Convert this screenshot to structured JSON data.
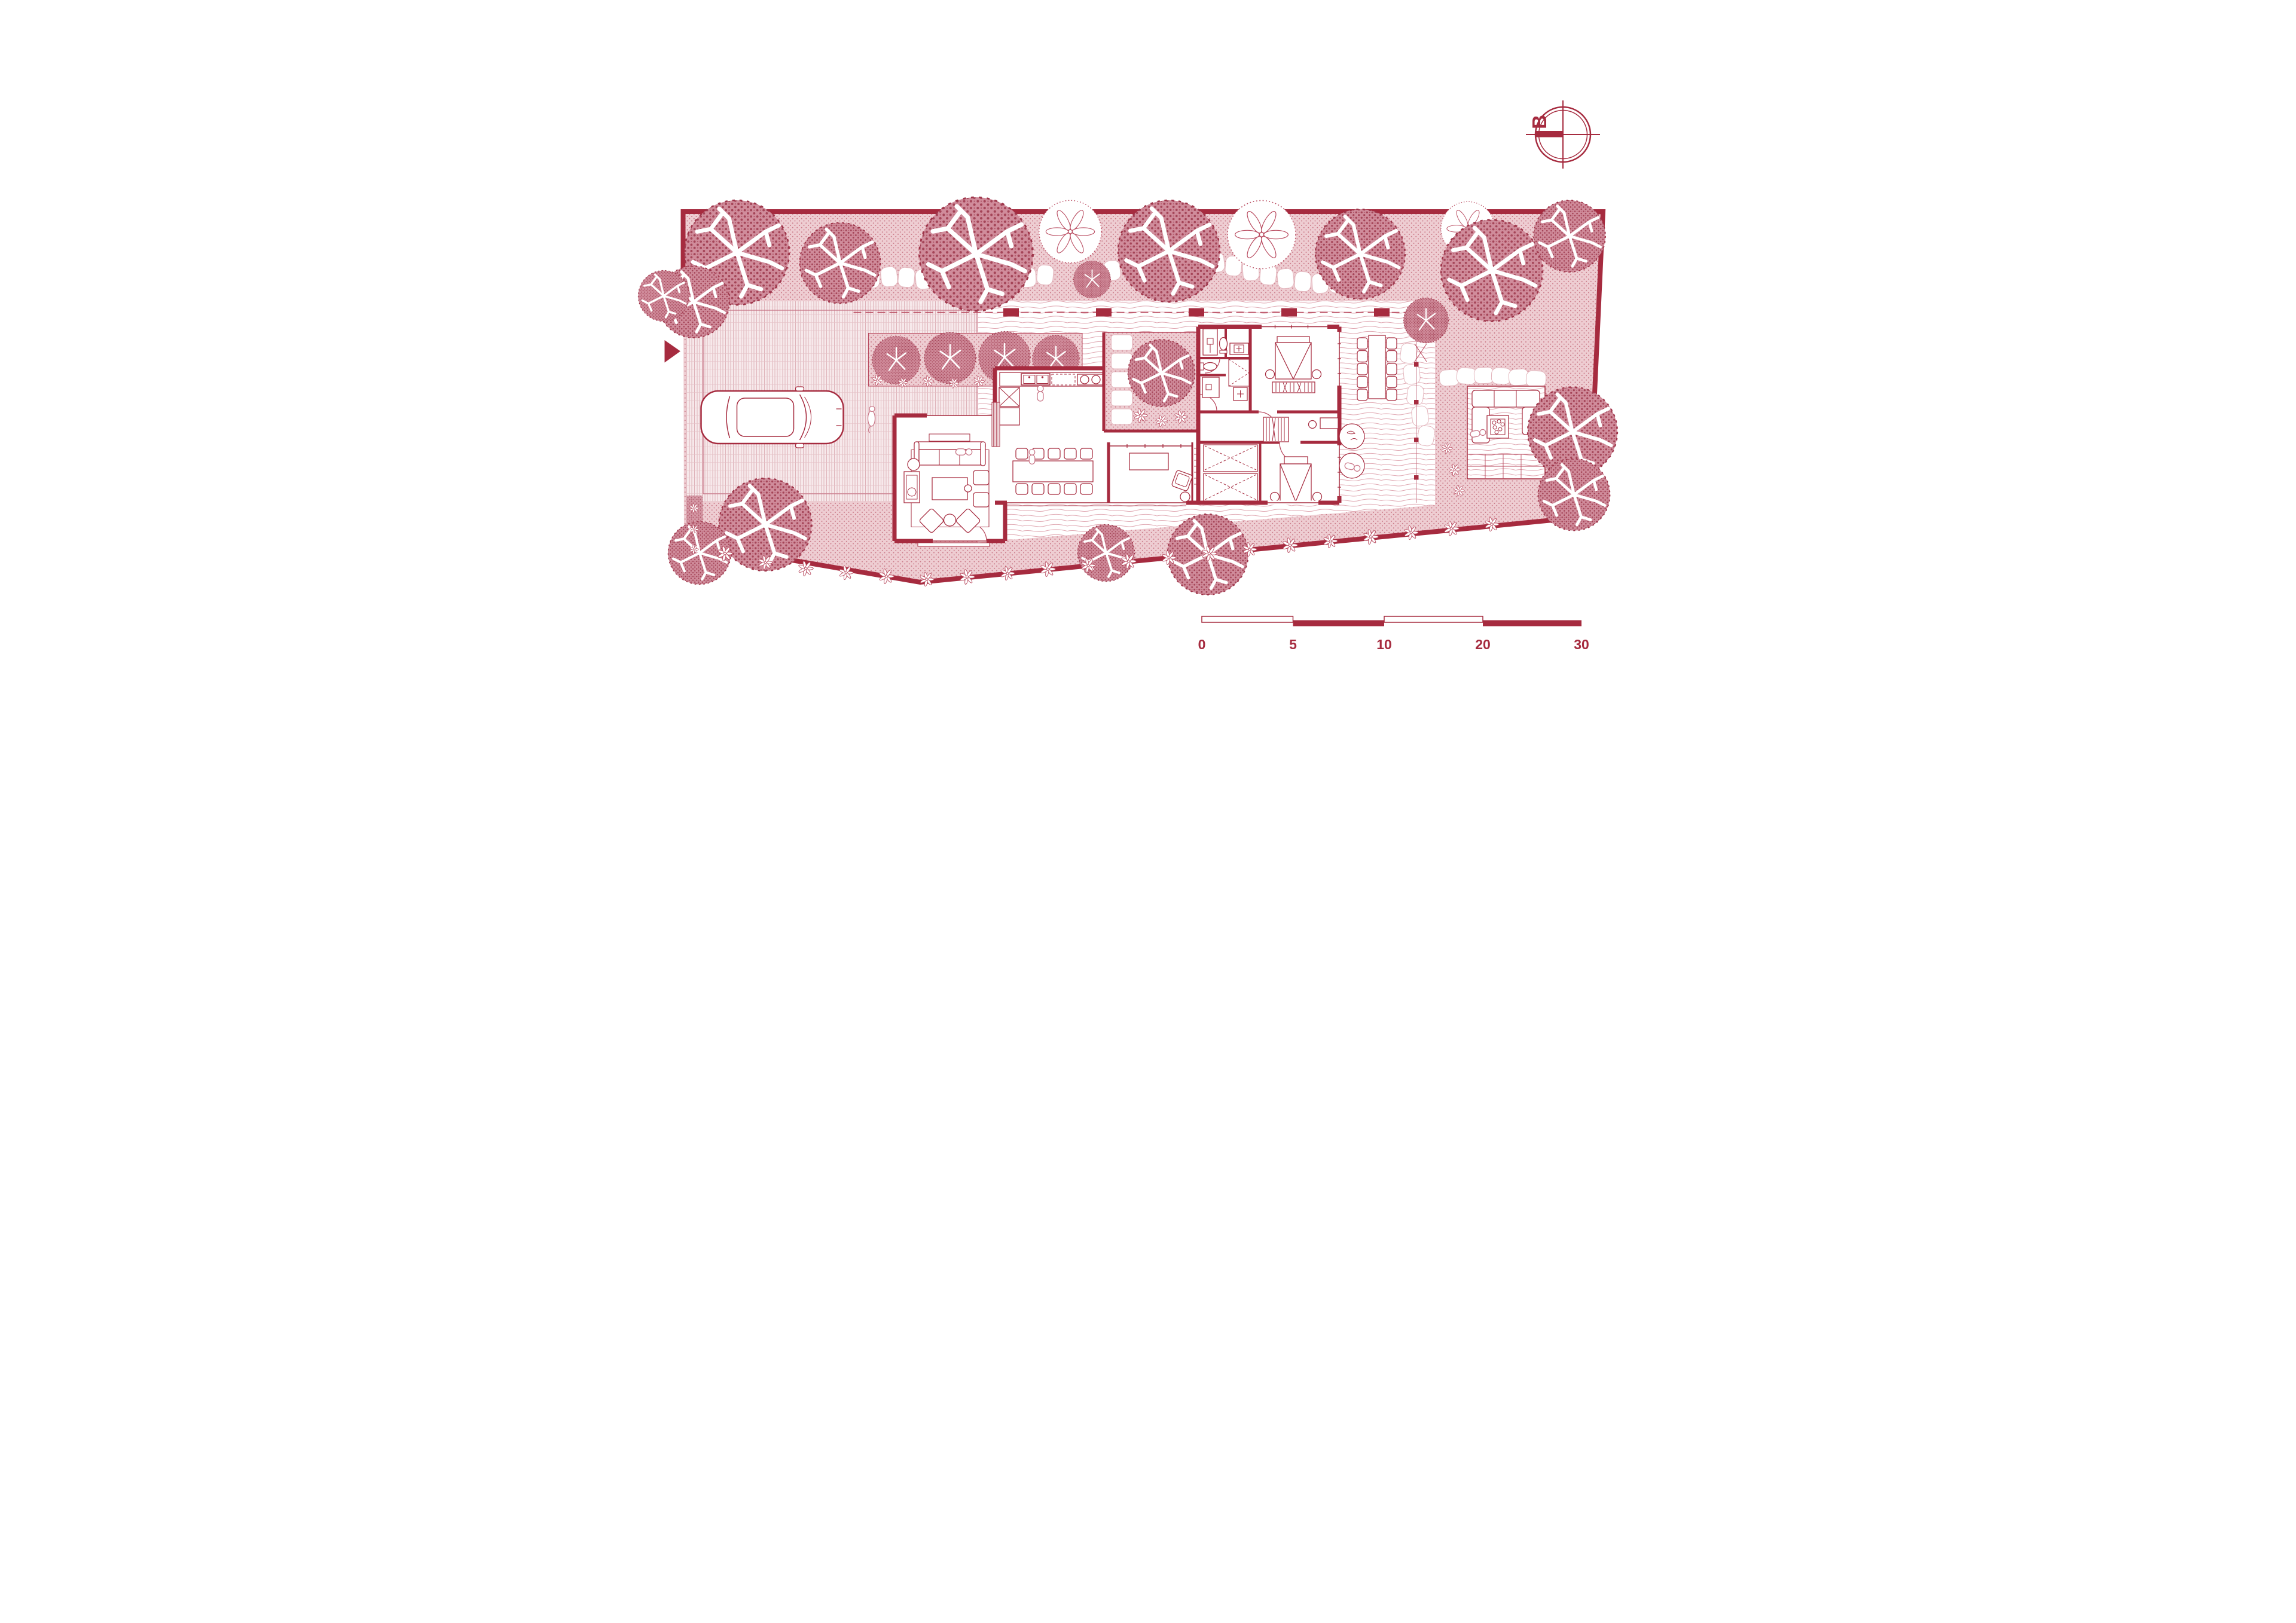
{
  "drawing": {
    "type": "architectural ground-floor site plan",
    "technique": "monochrome crimson ink drawing on white paper",
    "compass": {
      "letter": "B"
    },
    "scale_bar": {
      "labels": [
        "0",
        "5",
        "10",
        "20",
        "30"
      ],
      "style": "staggered alternating open and filled bar segments"
    },
    "palette": {
      "primary_red": "#a62b3f",
      "soft_pink": "#eecdd2",
      "dot_pink": "#b24458",
      "canopy_pink": "#d08c9b",
      "canopy_dot": "#993246",
      "lawn_line": "#e0a8b2",
      "hatch_line": "#d8a4ad",
      "stone_outline": "#e3b6bd",
      "paper": "#ffffff"
    },
    "site": {
      "shape": "irregular walled quadrilateral with slanted bottom boundary",
      "entry": "arrow marker at left boundary into driveway court",
      "zones": [
        "perimeter stippled garden with large canopy trees",
        "winding stepping-stone path along the top garden",
        "cross-hatched driveway court with parked car",
        "front lawn with dashed fence line and posts",
        "linear planting bed with four clipped shrubs",
        "internal planted courtyard with tree and stepping pads",
        "covered east terrace with column row",
        "outdoor lounge patio with fire pit",
        "flowering shrub band along the bottom boundary"
      ]
    },
    "house": {
      "rooms": [
        {
          "name": "living room",
          "furniture": [
            "three-seat sofa",
            "rug",
            "coffee table",
            "two armchairs",
            "two angled lounge chairs",
            "side cabinet with plant",
            "round side tables"
          ]
        },
        {
          "name": "kitchen",
          "furniture": [
            "straight counter",
            "double sink",
            "two-burner cooktop",
            "dishwasher",
            "pantry unit",
            "fridge",
            "louvre screen"
          ]
        },
        {
          "name": "dining area",
          "furniture": [
            "long table",
            "ten chairs"
          ]
        },
        {
          "name": "media room",
          "furniture": [
            "tv console",
            "swivel armchair",
            "round side table",
            "window band"
          ]
        },
        {
          "name": "bathroom block",
          "furniture": [
            "two showers",
            "two toilets",
            "two vanities",
            "linen closet"
          ]
        },
        {
          "name": "master bedroom",
          "furniture": [
            "double bed",
            "two round nightstands",
            "slatted bench"
          ]
        },
        {
          "name": "second bedroom",
          "furniture": [
            "bed",
            "two round nightstands",
            "desk with stool"
          ]
        },
        {
          "name": "wardrobe room",
          "furniture": [
            "two hanging closets"
          ]
        }
      ],
      "outdoor_furniture": [
        "outdoor dining table with ten chairs on covered terrace",
        "u-shaped patio sofa around square fire pit with pebbles",
        "two round planters, one with reclining person"
      ]
    },
    "figures": {
      "people": 5,
      "dog": 1,
      "car": 1
    },
    "counts": {
      "dining_chairs": 10,
      "outdoor_dining_chairs": 10,
      "large_trees": 16,
      "front_bed_shrubs": 4,
      "fence_posts": 5,
      "terrace_columns": 5
    }
  }
}
